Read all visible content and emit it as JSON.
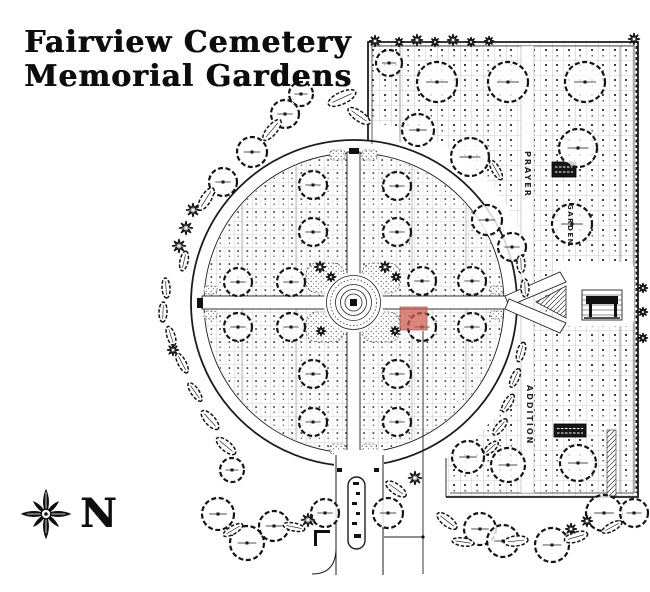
{
  "title": {
    "line1": "Fairview Cemetery",
    "line2": "Memorial Gardens"
  },
  "compass": {
    "label": "N"
  },
  "map": {
    "section_labels": {
      "prayer": "PRAYER",
      "garden": "GARDEN",
      "addition": "ADDITION"
    },
    "label_boxes": [
      {
        "id": "prayer-section-sign",
        "text": "",
        "legible": false
      },
      {
        "id": "addition-section-sign",
        "text": "",
        "legible": false
      }
    ],
    "highlight": {
      "x": 400,
      "y": 307,
      "width": 27,
      "height": 23,
      "color": "#ce5a4d"
    },
    "colors": {
      "ink": "#1c1c1c",
      "paper": "#ffffff",
      "grid_line": "#9b9b9b",
      "highlight": "#ce5a4d"
    }
  }
}
